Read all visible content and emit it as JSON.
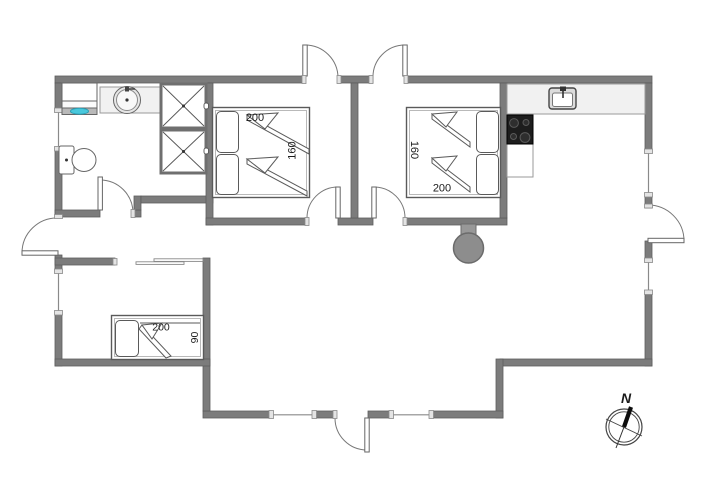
{
  "floorplan": {
    "bedroom1": {
      "bed_length_cm": "200",
      "bed_width_cm": "160"
    },
    "bedroom2": {
      "bed_length_cm": "200",
      "bed_width_cm": "160"
    },
    "bedroom3": {
      "bed_length_cm": "200",
      "bed_width_cm": "90"
    },
    "compass": {
      "north_label": "N"
    },
    "colors": {
      "wall": "#7c7c7c",
      "wall_edge": "#5d5d5d",
      "counter": "#f1f1f1",
      "cooktop": "#1d1d1d",
      "wood_stove": "#8d8d8d",
      "water": "#49c8dc",
      "outline": "#4a4a4a"
    },
    "fixtures": {
      "bathroom": [
        "washing-machine",
        "round-washbasin",
        "toilet",
        "cabinet",
        "cabinet"
      ],
      "kitchen": [
        "kitchen-sink",
        "cooktop"
      ],
      "living_room": [
        "wood-burning-stove"
      ],
      "doors": [
        "bedroom1-terrace-door",
        "bedroom2-terrace-door",
        "bathroom-door",
        "bedroom1-door",
        "bedroom2-door",
        "hall-exterior-door",
        "east-terrace-door",
        "main-entrance-door",
        "sliding-door"
      ],
      "windows_count": 6
    }
  }
}
